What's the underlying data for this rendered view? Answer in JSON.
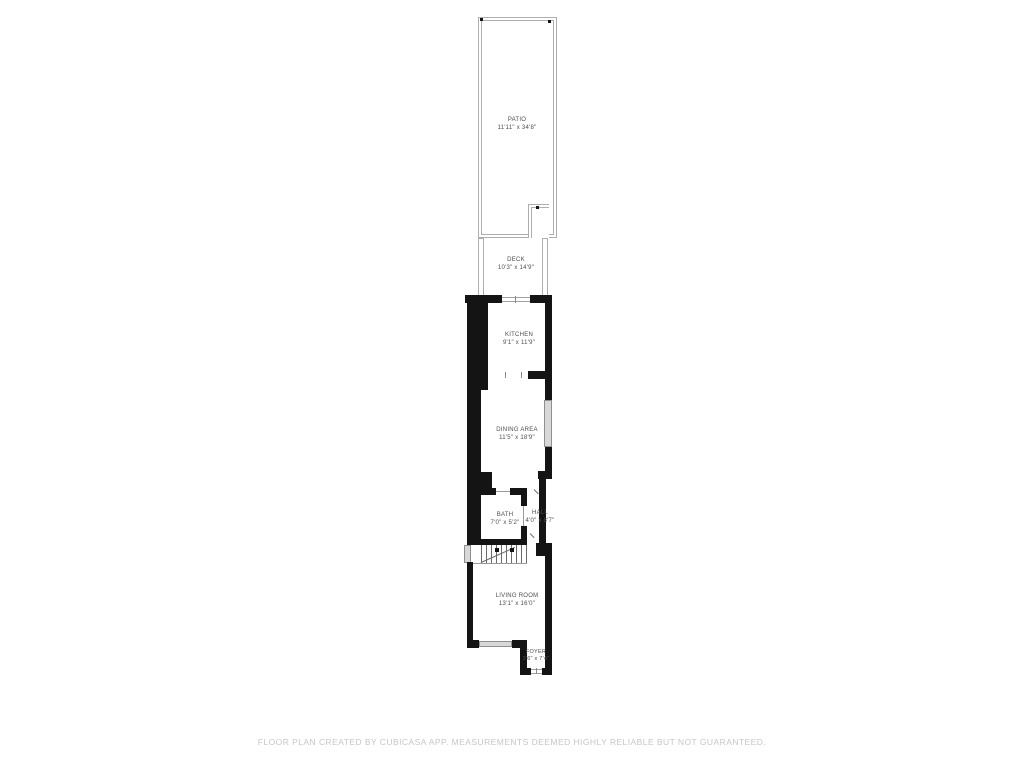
{
  "rooms": {
    "patio": {
      "name": "PATIO",
      "dims": "11'11\" x 34'8\""
    },
    "deck": {
      "name": "DECK",
      "dims": "10'3\" x 14'9\""
    },
    "kitchen": {
      "name": "KITCHEN",
      "dims": "9'1\" x 11'9\""
    },
    "dining": {
      "name": "DINING AREA",
      "dims": "11'5\" x 18'9\""
    },
    "bath": {
      "name": "BATH",
      "dims": "7'0\" x 5'2\""
    },
    "hall": {
      "name": "HALL",
      "dims": "4'0\" x 8'7\""
    },
    "living": {
      "name": "LIVING ROOM",
      "dims": "13'1\" x 16'0\""
    },
    "foyer": {
      "name": "FOYER",
      "dims": "3'6\" x 7'4\""
    }
  },
  "footer": {
    "disclaimer": "FLOOR PLAN CREATED BY CUBICASA APP. MEASUREMENTS DEEMED HIGHLY RELIABLE BUT NOT GUARANTEED."
  },
  "colors": {
    "wall": "#141414",
    "outline": "#aeaeae",
    "window": "#d8d8d8",
    "label": "#4d4d4d",
    "disclaimer": "#c6c6c6"
  }
}
